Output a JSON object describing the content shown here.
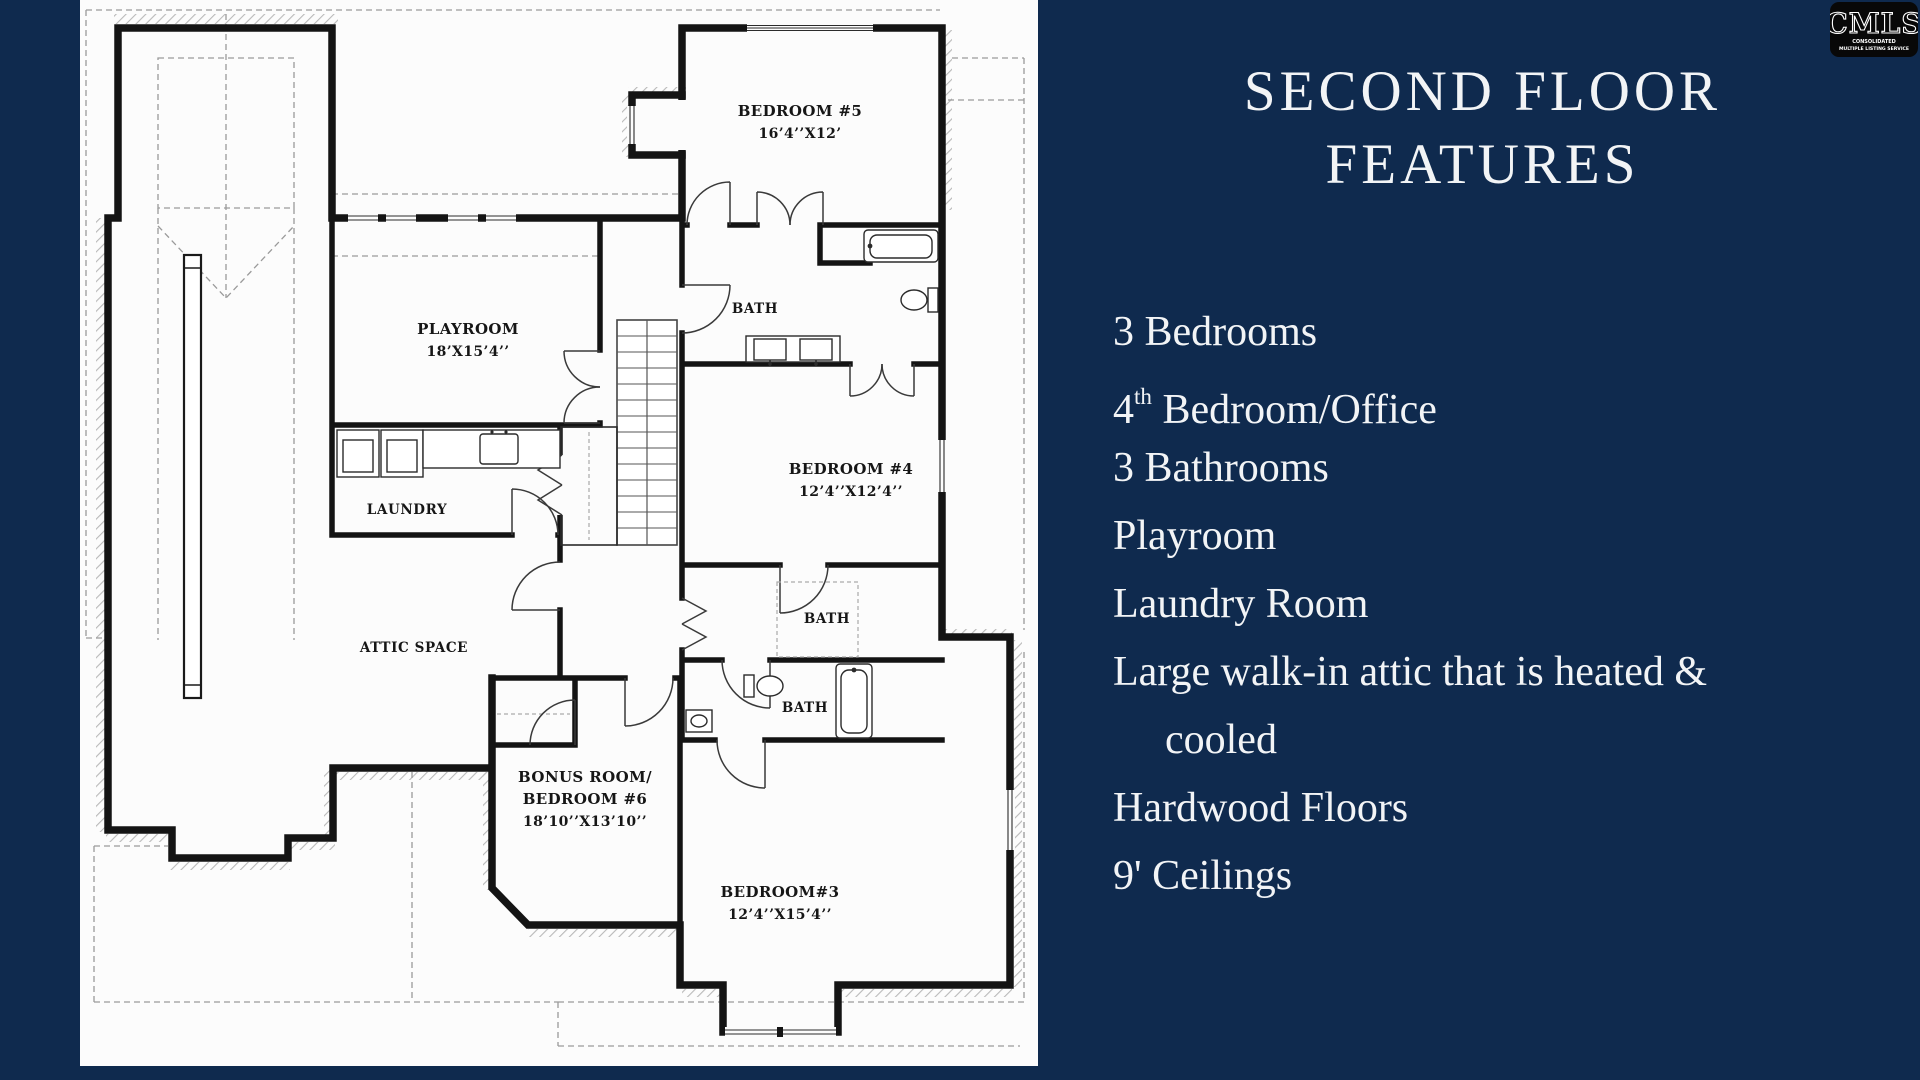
{
  "background_color": "#0F2A4E",
  "plan_background": "#FCFCFC",
  "text_color": "#F2F4F6",
  "plan": {
    "labels": {
      "bedroom5": {
        "line1": "BEDROOM #5",
        "line2": "16’4’’X12’"
      },
      "playroom": {
        "line1": "PLAYROOM",
        "line2": "18’X15’4’’"
      },
      "bath1": "BATH",
      "bedroom4": {
        "line1": "BEDROOM #4",
        "line2": "12’4’’X12’4’’"
      },
      "laundry": "LAUNDRY",
      "attic": "ATTIC SPACE",
      "bath2": "BATH",
      "bath3": "BATH",
      "bonus": {
        "line1": "BONUS ROOM/",
        "line2": "BEDROOM #6",
        "line3": "18’10’’X13’10’’"
      },
      "bedroom3": {
        "line1": "BEDROOM#3",
        "line2": "12’4’’X15’4’’"
      }
    }
  },
  "features": {
    "title_line1": "SECOND FLOOR",
    "title_line2": "FEATURES",
    "items": [
      {
        "pre": "3 Bedrooms"
      },
      {
        "pre": "4",
        "sup": "th",
        "post": " Bedroom/Office"
      },
      {
        "pre": "3 Bathrooms"
      },
      {
        "pre": "Playroom"
      },
      {
        "pre": "Laundry Room"
      },
      {
        "pre": "Large walk-in attic that is heated &",
        "wrap": "cooled"
      },
      {
        "pre": "Hardwood Floors"
      },
      {
        "pre": "9' Ceilings"
      }
    ]
  },
  "logo": {
    "text": "CMLS",
    "sub1": "CONSOLIDATED",
    "sub2": "MULTIPLE LISTING SERVICE"
  }
}
